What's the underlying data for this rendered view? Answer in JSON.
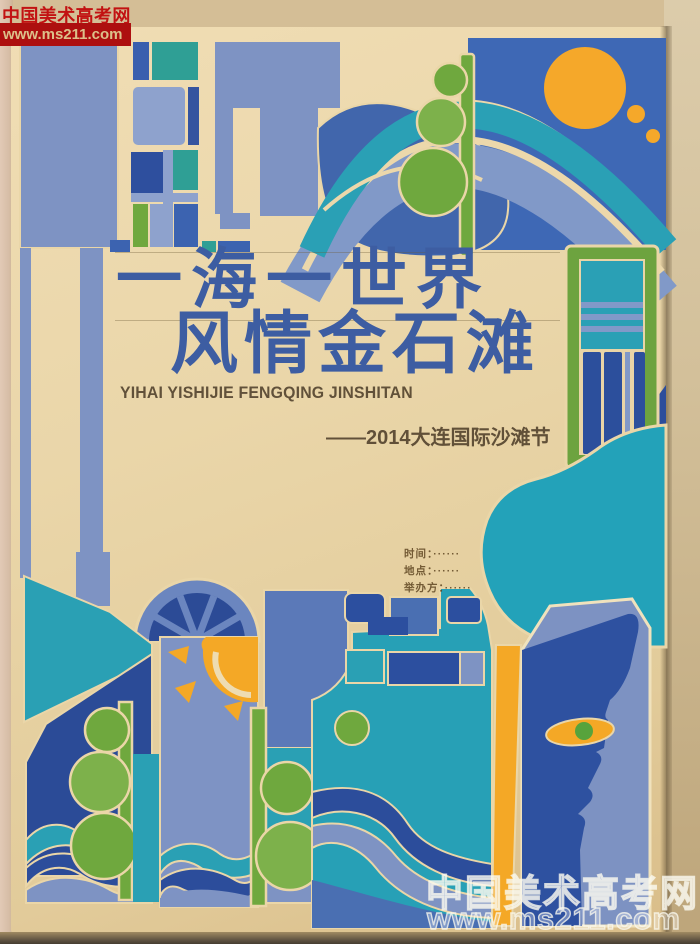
{
  "watermark_top": {
    "site_name": "中国美术高考网",
    "site_url": "www.ms211.com"
  },
  "watermark_bottom": {
    "site_name": "中国美术高考网",
    "site_url": "www.ms211.com"
  },
  "poster": {
    "title_line1": "一海一世界",
    "title_line2": "风情金石滩",
    "pinyin": "YIHAI YISHIJIE FENGQING JINSHITAN",
    "subtitle": "——2014大连国际沙滩节",
    "info_lines": [
      {
        "text": "时间：······"
      },
      {
        "text": "地点：······"
      },
      {
        "text": "举办方：······"
      }
    ]
  },
  "colors": {
    "periwinkle": "#7e93c3",
    "medium_blue": "#4a6fb2",
    "navy": "#2c4d9b",
    "sky_blue": "#3e68b5",
    "teal": "#2aa0b5",
    "green": "#6fa83e",
    "orange": "#f4a826",
    "paper_cream": "#e8d4a6",
    "title_blue": "#3d5da2",
    "watermark_red": "#ad0f0f"
  }
}
